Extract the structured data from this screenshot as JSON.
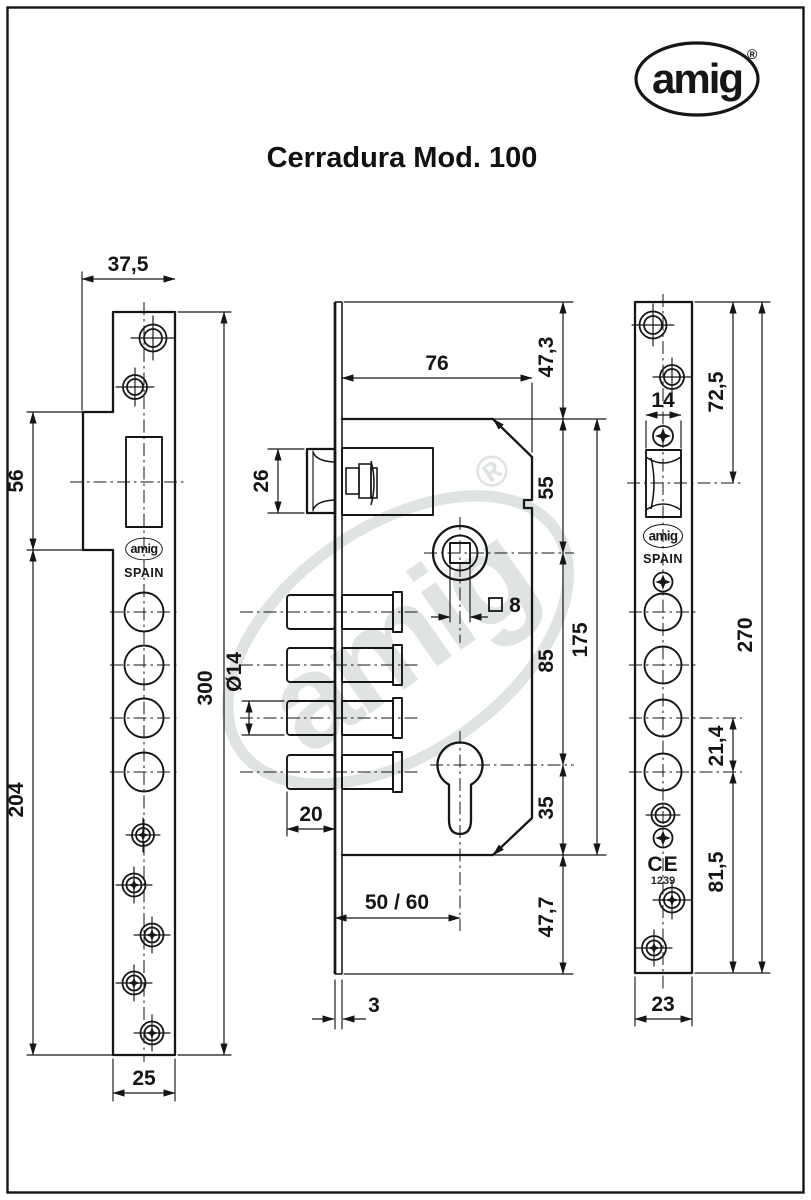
{
  "page": {
    "title": "Cerradura Mod. 100"
  },
  "brand": {
    "logo_text": "amig",
    "registered": "®",
    "spain_label": "SPAIN"
  },
  "left_view": {
    "dims": {
      "top_width": "37,5",
      "flange_height": "56",
      "lower_height": "204",
      "total_height": "300",
      "bottom_width": "25"
    }
  },
  "middle_view": {
    "dims": {
      "body_depth": "76",
      "top_offset": "47,3",
      "latch_height": "26",
      "hub_from_top": "55",
      "hub_to_cylinder": "85",
      "body_height": "175",
      "cylinder_to_bottom": "35",
      "bottom_offset": "47,7",
      "bolt_diameter": "Ø14",
      "bolt_protrusion": "20",
      "square_size": "8",
      "backset": "50 / 60",
      "plate_thickness": "3"
    }
  },
  "right_view": {
    "ce_mark": "CE",
    "ce_number": "1239",
    "dims": {
      "top_to_latch": "72,5",
      "latch_width": "14",
      "total_height": "270",
      "hole_spacing": "21,4",
      "bottom_section": "81,5",
      "width": "23"
    }
  }
}
